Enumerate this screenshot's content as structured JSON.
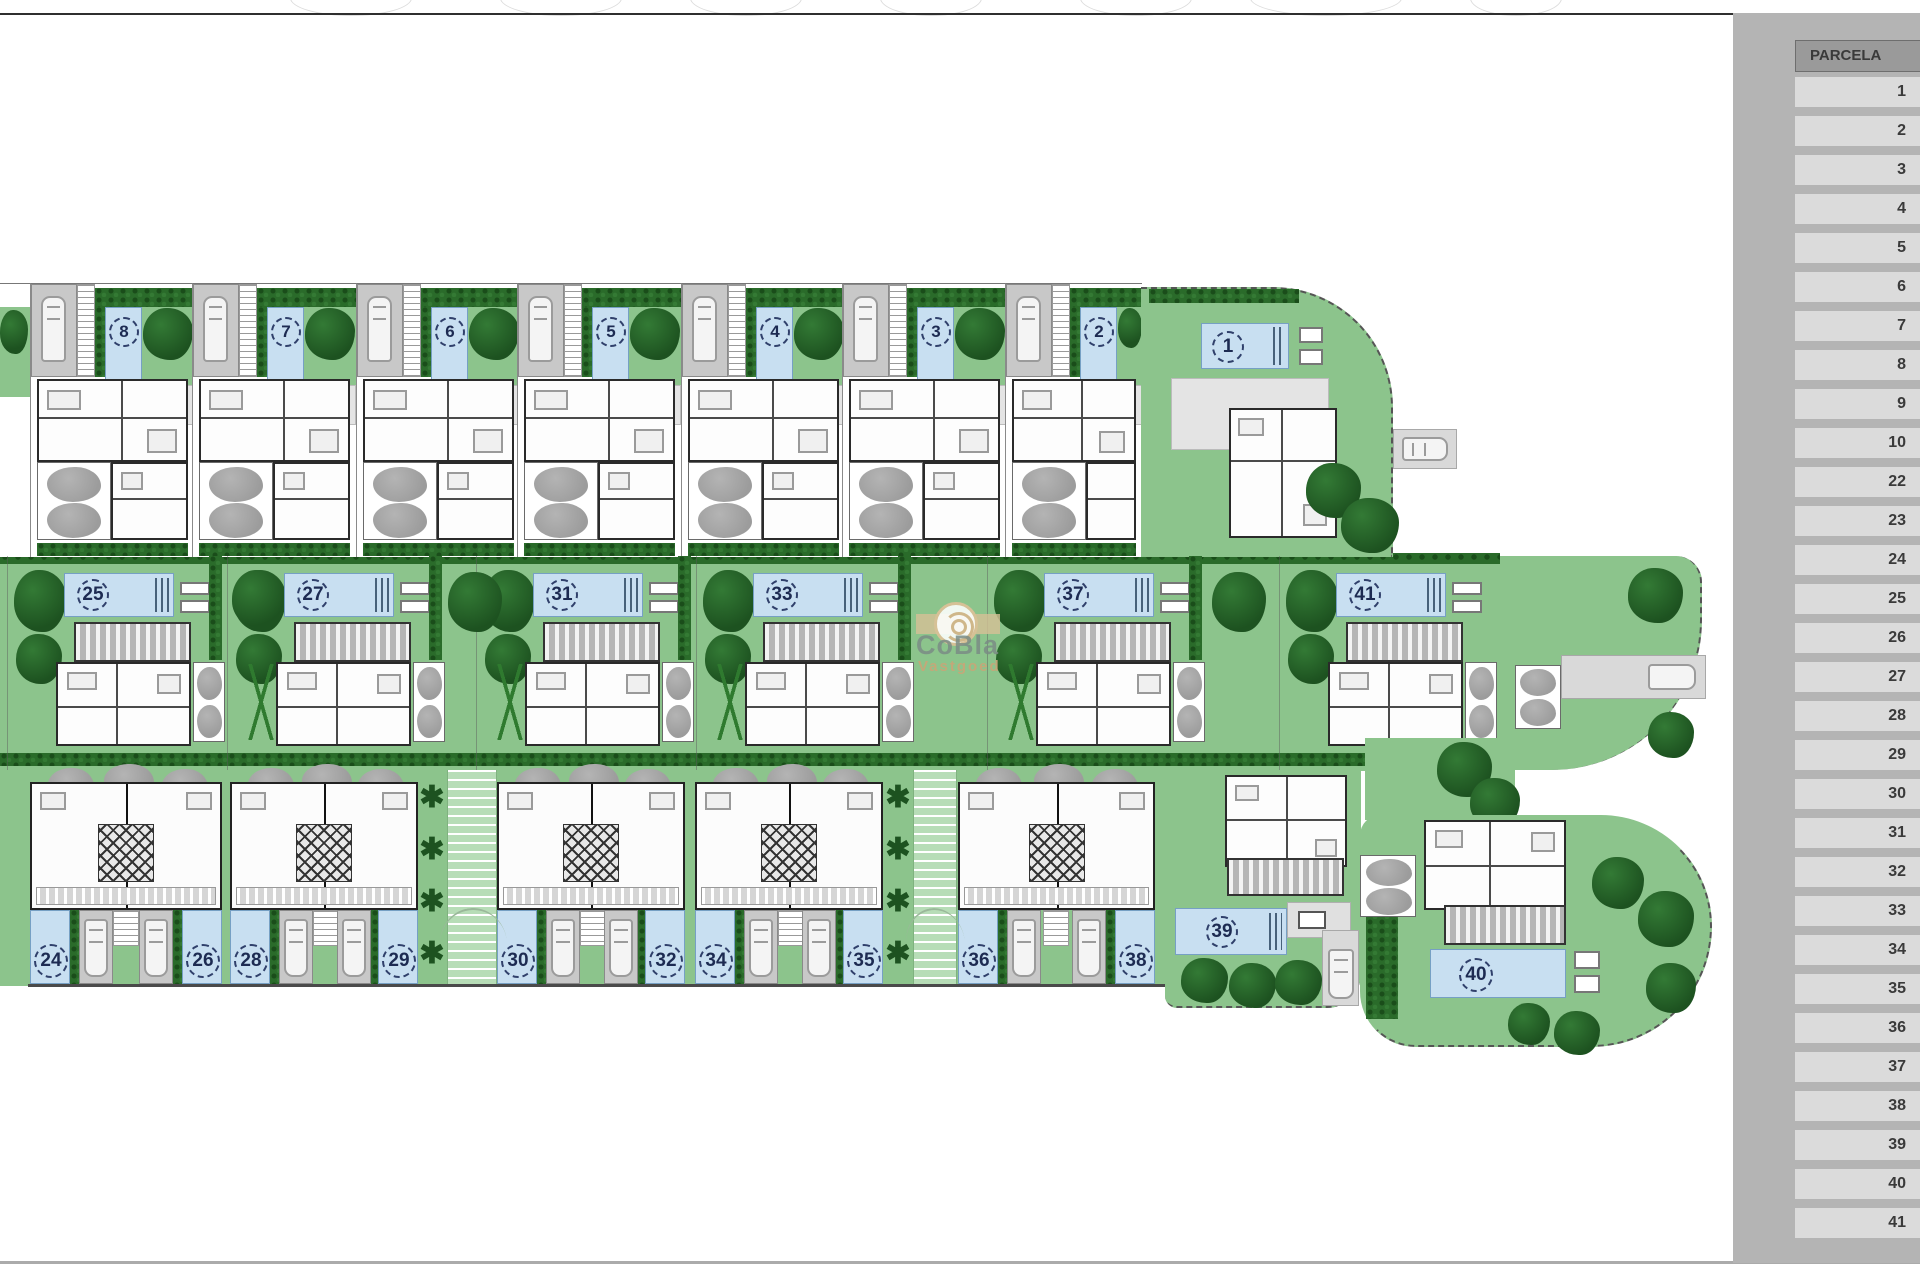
{
  "sidebar": {
    "title": "PARCELA",
    "rows": [
      "1",
      "2",
      "3",
      "4",
      "5",
      "6",
      "7",
      "8",
      "9",
      "10",
      "22",
      "23",
      "24",
      "25",
      "26",
      "27",
      "28",
      "29",
      "30",
      "31",
      "32",
      "33",
      "34",
      "35",
      "36",
      "37",
      "38",
      "39",
      "40",
      "41"
    ]
  },
  "watermark": {
    "brand": "CoBla",
    "subtitle": "Vastgoed"
  },
  "plan": {
    "top_units": [
      {
        "number": "8"
      },
      {
        "number": "7"
      },
      {
        "number": "6"
      },
      {
        "number": "5"
      },
      {
        "number": "4"
      },
      {
        "number": "3"
      },
      {
        "number": "2"
      }
    ],
    "parcel_1": {
      "number": "1"
    },
    "middle_units": [
      {
        "number": "25"
      },
      {
        "number": "27"
      },
      {
        "number": "31"
      },
      {
        "number": "33"
      },
      {
        "number": "37"
      },
      {
        "number": "41"
      }
    ],
    "bottom_pairs": [
      {
        "left": "24",
        "right": "26"
      },
      {
        "left": "28",
        "right": "29"
      },
      {
        "left": "30",
        "right": "32"
      },
      {
        "left": "34",
        "right": "35"
      },
      {
        "left": "36",
        "right": "38"
      }
    ],
    "parcel_39": {
      "number": "39"
    },
    "parcel_40": {
      "number": "40"
    }
  },
  "colors": {
    "lawn": "#8cc48c",
    "walkway": "#b7ddb7",
    "tree": "#1d5220",
    "hedge": "#2a6b2a",
    "pool": "#c8dff1",
    "poolborder": "#76a0c4",
    "num": "#1d2b52",
    "wall": "#2a2a2a",
    "garage": "#c8c8c8",
    "graytree": "#9c9c9c",
    "panel": "#b4b4b4",
    "panelheader": "#9a9a9a",
    "panelrow": "#dbdbdb",
    "paneltext": "#3a3a3a",
    "brandtan": "#c8a87a",
    "brandgray": "#7a8c85"
  }
}
